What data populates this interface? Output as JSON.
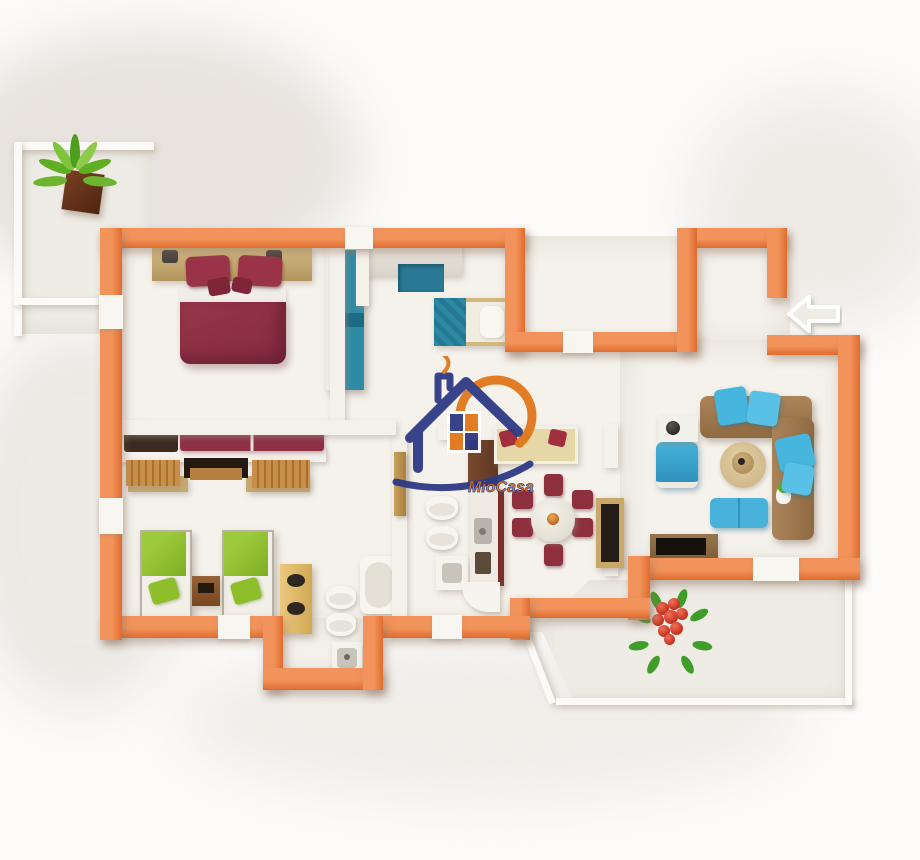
{
  "meta": {
    "image_type": "3d-floor-plan-render",
    "description": "Top-down 3D model of an apartment with orange walls on a white studio background"
  },
  "watermark": {
    "brand": "MioCasa"
  },
  "entrance": {
    "arrow_direction": "left"
  },
  "colors": {
    "wall-top": "#F2935B",
    "wall-side": "#E06C2E",
    "floor": "#F5F2EC",
    "bg": "#FCFBFA",
    "navy": "#2E3A85",
    "logo-orange": "#E2761B",
    "maroon": "#8E2F42",
    "teal": "#2E8BA6",
    "blue": "#47B6DF",
    "green": "#8FBE2B",
    "tan": "#C9AF7C",
    "sofa": "#A1794E"
  },
  "scene": {
    "rooms": [
      {
        "name": "balcony-top-left",
        "items": [
          "potted-plant"
        ]
      },
      {
        "name": "master-bedroom",
        "items": [
          "double-bed-maroon",
          "headboard-with-nightstands",
          "two-table-lamps",
          "teal-wardrobe",
          "storage-bench-with-cushions"
        ]
      },
      {
        "name": "study-bedroom",
        "items": [
          "white-desk",
          "teal-chair",
          "single-bed-teal"
        ]
      },
      {
        "name": "kids-bedroom",
        "items": [
          "green-single-bed",
          "green-single-bed",
          "wood-nightstand",
          "tan-wardrobe",
          "headboard-shelves"
        ]
      },
      {
        "name": "bathroom-center",
        "items": [
          "wall-hung-toilet",
          "bidet",
          "washbasin",
          "open-door"
        ]
      },
      {
        "name": "bathroom-bottom",
        "items": [
          "bathtub",
          "toilet",
          "bidet",
          "washbasin"
        ]
      },
      {
        "name": "kitchen",
        "items": [
          "tall-cabinet",
          "counter-with-sink",
          "cooktop",
          "corner-unit"
        ]
      },
      {
        "name": "dining-area",
        "items": [
          "cream-bench-with-red-pillows",
          "round-table",
          "six-maroon-chairs",
          "tall-display-cabinet"
        ]
      },
      {
        "name": "living-room",
        "items": [
          "brown-corner-sofa",
          "blue-cushions",
          "blue-armchair",
          "side-table-with-lamp",
          "round-rug",
          "coffee-table",
          "blue-ottomans",
          "tv-stand",
          "tv"
        ]
      },
      {
        "name": "entry-nook",
        "items": [
          "entrance-arrow"
        ]
      },
      {
        "name": "terrace-bottom-right",
        "items": [
          "red-flower-plant"
        ]
      }
    ]
  }
}
